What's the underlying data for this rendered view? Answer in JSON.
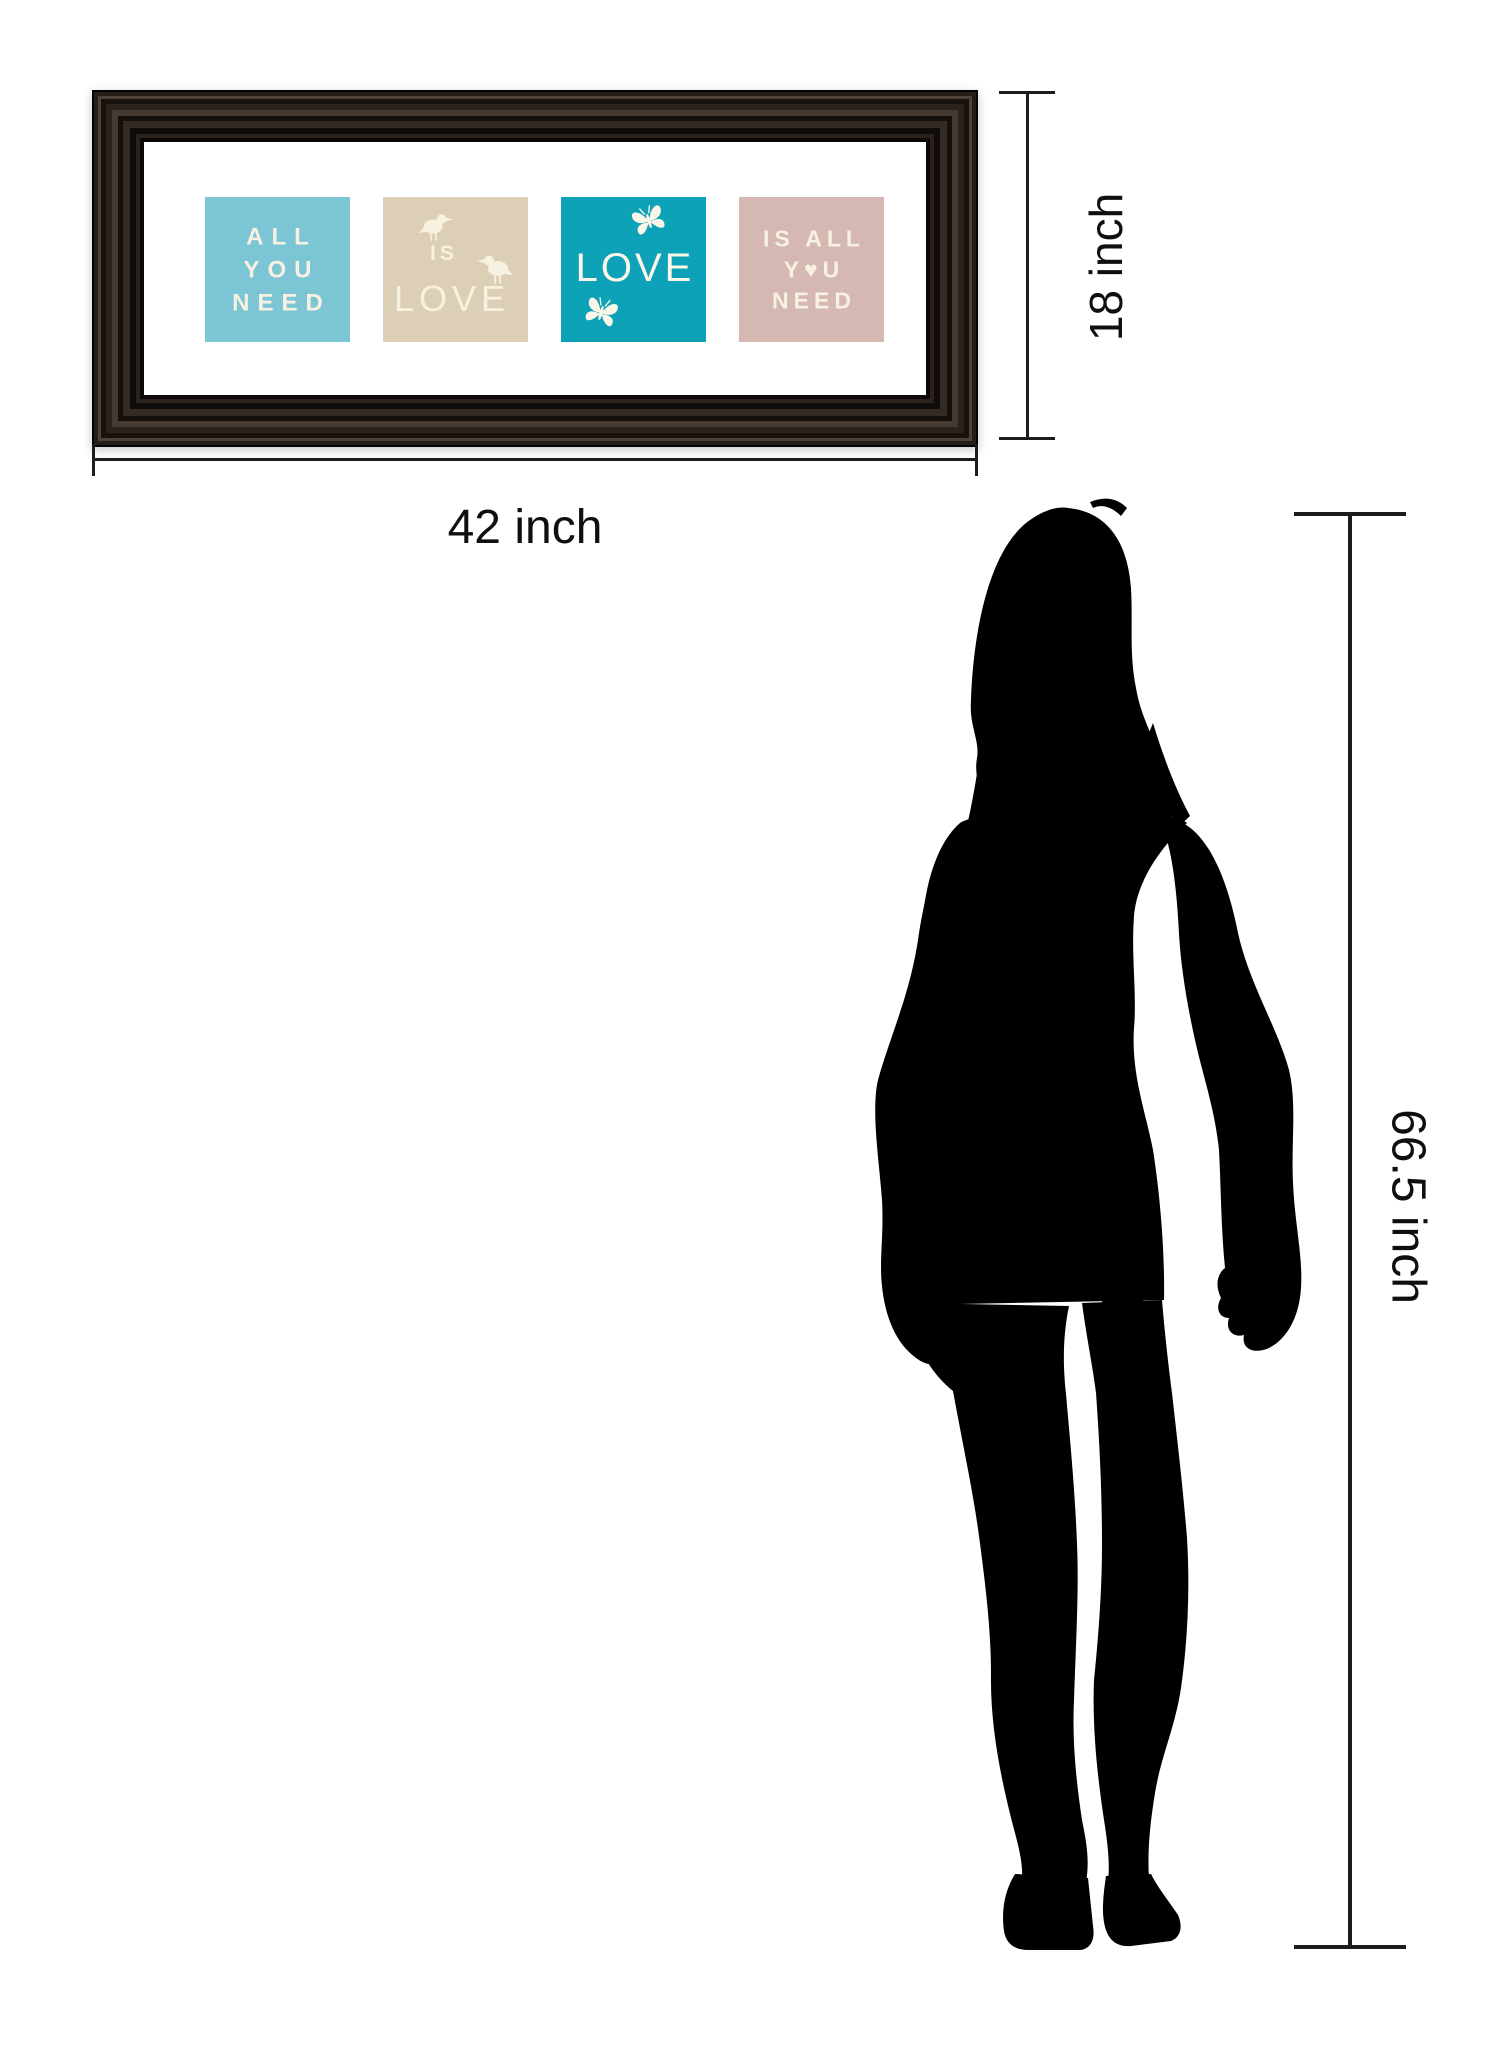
{
  "artwork": {
    "frame_color": "#1d1712",
    "mat_color": "#ffffff",
    "text_color": "#f7f1e1",
    "panels": [
      {
        "bg": "#7cc5d5",
        "lines": [
          "ALL",
          "YOU",
          "NEED"
        ]
      },
      {
        "bg": "#ddcfb5",
        "word_small": "IS",
        "word_large": "LOVE",
        "icons": [
          "bird-icon",
          "bird-icon"
        ]
      },
      {
        "bg": "#0da2b8",
        "word_large": "LOVE",
        "icons": [
          "butterfly-icon",
          "butterfly-icon"
        ]
      },
      {
        "bg": "#d5b8b2",
        "lines": [
          "IS ALL",
          "Y♥U",
          "NEED"
        ]
      }
    ]
  },
  "dimensions": {
    "frame_height_label": "18 inch",
    "frame_width_label": "42 inch",
    "person_height_label": "66.5 inch",
    "line_color": "#1c1c1c"
  },
  "silhouette": {
    "color": "#000000"
  }
}
